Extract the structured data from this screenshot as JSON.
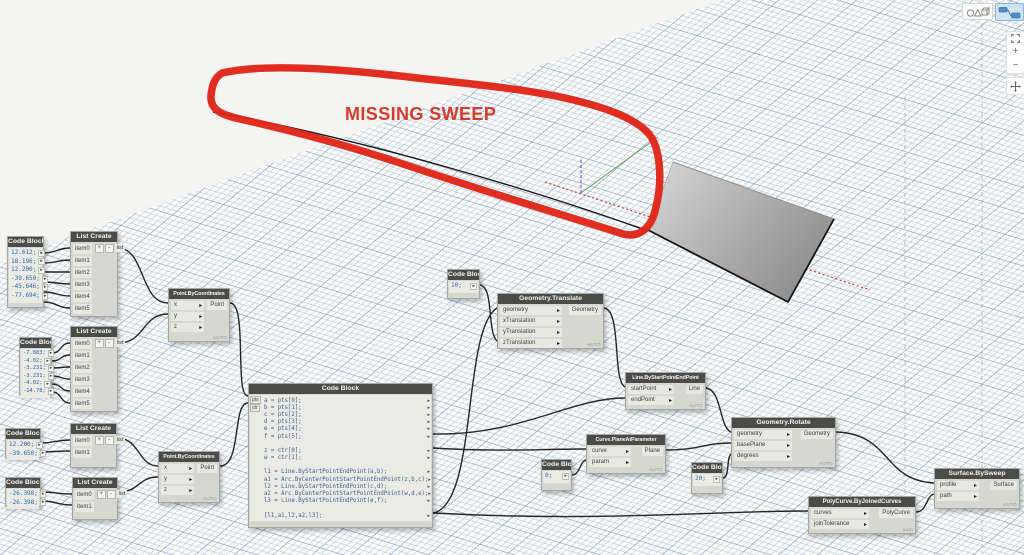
{
  "annotation": {
    "label": "MISSING SWEEP",
    "color": "#d23b2d"
  },
  "colors": {
    "node_header": "#4b4b49",
    "node_body": "#d7d7d2",
    "port": "#e8e8e3",
    "wire": "#262624",
    "grid_line": "#7a98bc",
    "code_text": "#2a64ad",
    "annotation_red": "#e02518",
    "axis_x_red": "#c23b33",
    "axis_green": "#66a355",
    "axis_blue_dashed": "#7070c0",
    "surface_light": "#d8d8d8",
    "surface_dark": "#8f8f8f",
    "active_button_bg": "#cfe3f5"
  },
  "toolbar": {
    "geometry_button_icon": "geometry-shapes-icon",
    "graph_button_icon": "graph-nodes-icon",
    "zoom_in": "+",
    "zoom_out": "−",
    "fit_icon": "zoom-to-fit-icon",
    "pan_icon": "pan-icon"
  },
  "nodes": {
    "code_block_1": {
      "title": "Code Block",
      "lines": [
        "12.612;",
        "18.196;",
        "12.200;",
        "-39.650;",
        "-45.646;",
        "-77.694;"
      ]
    },
    "list_create_1": {
      "title": "List Create",
      "items": [
        "item0",
        "item1",
        "item2",
        "item3",
        "item4",
        "item5"
      ],
      "add": "+",
      "remove": "-",
      "output": "list"
    },
    "code_block_2": {
      "title": "Code Block",
      "lines": [
        "-7.883;",
        "-4.02;",
        "-3.231;",
        "-3.231;",
        "-4.02;",
        "-14.78;"
      ]
    },
    "list_create_2": {
      "title": "List Create",
      "items": [
        "item0",
        "item1",
        "item2",
        "item3",
        "item4",
        "item5"
      ],
      "add": "+",
      "remove": "-",
      "output": "list"
    },
    "code_block_3": {
      "title": "Code Block",
      "lines": [
        "12.200;",
        "-39.650;"
      ]
    },
    "list_create_3": {
      "title": "List Create",
      "items": [
        "item0",
        "item1"
      ],
      "add": "+",
      "remove": "-",
      "output": "list"
    },
    "code_block_4": {
      "title": "Code Block",
      "lines": [
        "-26.398;",
        "-26.398;"
      ]
    },
    "list_create_4": {
      "title": "List Create",
      "items": [
        "item0",
        "item1"
      ],
      "add": "+",
      "remove": "-",
      "output": "list"
    },
    "point_by_coordinates_1": {
      "title": "Point.ByCoordinates",
      "inputs": [
        "x",
        "y",
        "z"
      ],
      "output": "Point",
      "lacing": "AUTO"
    },
    "point_by_coordinates_2": {
      "title": "Point.ByCoordinates",
      "inputs": [
        "x",
        "y",
        "z"
      ],
      "output": "Point",
      "lacing": "AUTO"
    },
    "code_block_main": {
      "title": "Code Block",
      "inputs": [
        "pts",
        "ctr"
      ],
      "lines": [
        "a = pts[0];",
        "b = pts[1];",
        "c = pts[2];",
        "d = pts[3];",
        "e = pts[4];",
        "f = pts[5];",
        "",
        "z = ctr[0];",
        "w = ctr[1];",
        "",
        "l1 = Line.ByStartPointEndPoint(a,b);",
        "a1 = Arc.ByCenterPointStartPointEndPoint(z,b,c);",
        "l2 = Line.ByStartPointEndPoint(c,d);",
        "a2 = Arc.ByCenterPointStartPointEndPoint(w,d,e);",
        "l3 = Line.ByStartPointEndPoint(e,f);",
        "",
        "[l1,a1,l2,a2,l3];"
      ]
    },
    "code_block_10": {
      "title": "Code Block",
      "lines": [
        "10;"
      ]
    },
    "geometry_translate": {
      "title": "Geometry.Translate",
      "inputs": [
        "geometry",
        "xTranslation",
        "yTranslation",
        "zTranslation"
      ],
      "output": "Geometry",
      "lacing": "AUTO"
    },
    "line_by_start_point_end_point": {
      "title": "Line.ByStartPointEndPoint",
      "inputs": [
        "startPoint",
        "endPoint"
      ],
      "output": "Line",
      "lacing": "AUTO"
    },
    "curve_plane_at_parameter": {
      "title": "Curve.PlaneAtParameter",
      "inputs": [
        "curve",
        "param"
      ],
      "output": "Plane",
      "lacing": "AUTO"
    },
    "code_block_0": {
      "title": "Code Block",
      "lines": [
        "0;"
      ]
    },
    "geometry_rotate": {
      "title": "Geometry.Rotate",
      "inputs": [
        "geometry",
        "basePlane",
        "degrees"
      ],
      "output": "Geometry",
      "lacing": "AUTO"
    },
    "code_block_20": {
      "title": "Code Block",
      "lines": [
        "20;"
      ]
    },
    "polycurve_by_joined_curves": {
      "title": "PolyCurve.ByJoinedCurves",
      "inputs": [
        "curves",
        "joinTolerance"
      ],
      "output": "PolyCurve",
      "lacing": "auto"
    },
    "surface_by_sweep": {
      "title": "Surface.BySweep",
      "inputs": [
        "profile",
        "path"
      ],
      "output": "Surface",
      "lacing": "AUTO"
    }
  }
}
